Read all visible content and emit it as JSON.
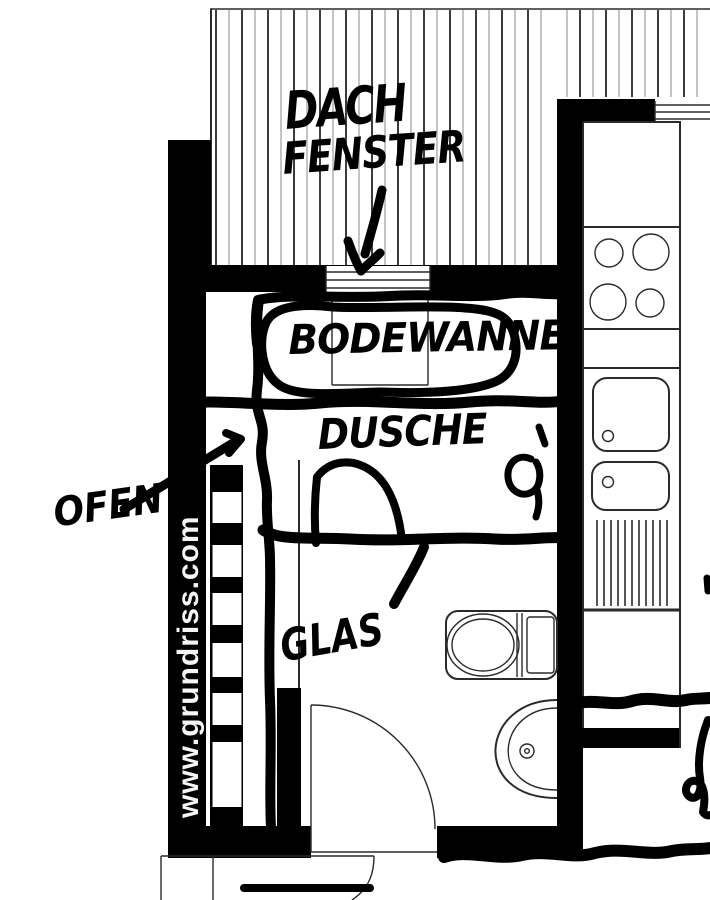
{
  "annotations": {
    "dach_fenster_line1": "DACH",
    "dach_fenster_line2": "FENSTER",
    "bodewanne": "BODEWANNE",
    "dusche": "DUSCHE",
    "glas": "GLAS",
    "ofen": "OFEN"
  },
  "watermark": "www.grundriss.com",
  "colors": {
    "ink": "#000000",
    "plan-line": "#2a2a2a",
    "hatch-dark": "#3c3c3c",
    "hatch-light": "#9c9c9c",
    "background": "#ffffff",
    "watermark-text": "#f5f5f5"
  }
}
